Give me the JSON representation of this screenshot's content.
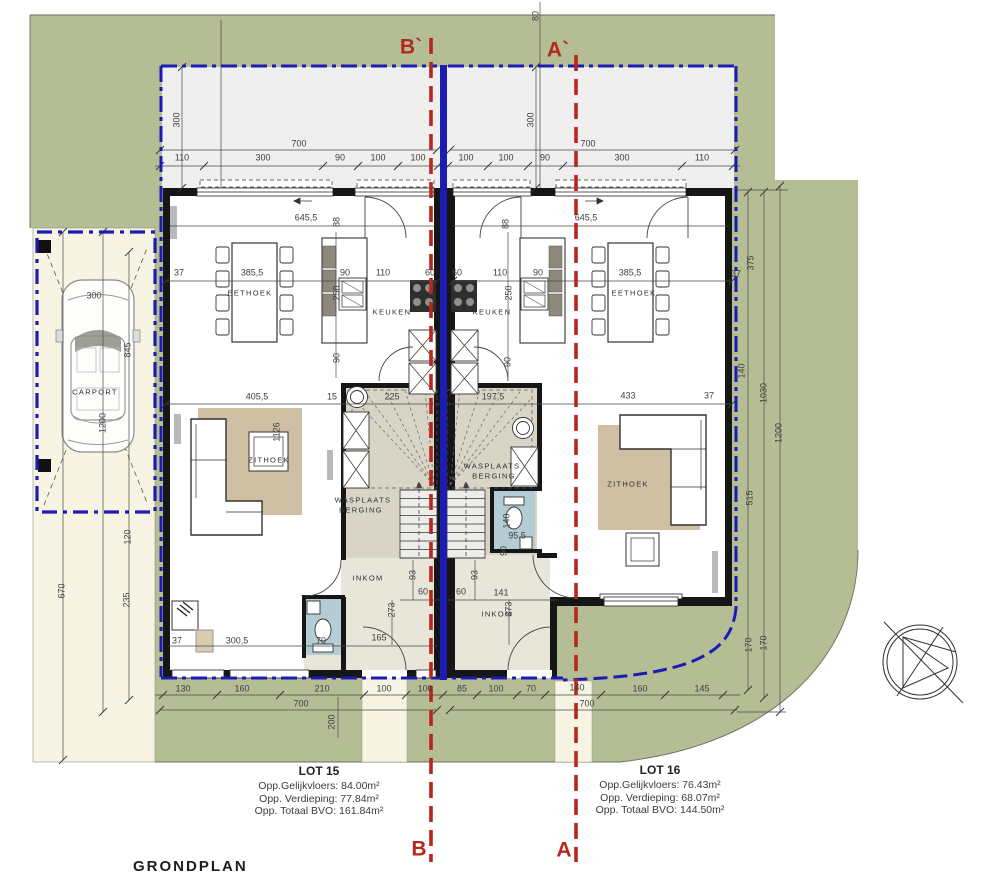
{
  "title": "GRONDPLAN",
  "section_labels": {
    "b_top": "B`",
    "a_top": "A`",
    "b_bottom": "B",
    "a_bottom": "A"
  },
  "lots": {
    "lot15": {
      "name": "LOT 15",
      "lines": [
        "Opp.Gelijkvloers: 84.00m²",
        "Opp. Verdieping: 77.84m²",
        "Opp. Totaal BVO: 161.84m²"
      ]
    },
    "lot16": {
      "name": "LOT 16",
      "lines": [
        "Opp.Gelijkvloers: 76.43m²",
        "Opp. Verdieping: 68.07m²",
        "Opp. Totaal BVO: 144.50m²"
      ]
    }
  },
  "rooms": [
    {
      "t": "EETHOEK",
      "x": 250,
      "y": 293
    },
    {
      "t": "EETHOEK",
      "x": 634,
      "y": 293
    },
    {
      "t": "KEUKEN",
      "x": 392,
      "y": 312
    },
    {
      "t": "KEUKEN",
      "x": 492,
      "y": 312
    },
    {
      "t": "ZITHOEK",
      "x": 269,
      "y": 460
    },
    {
      "t": "ZITHOEK",
      "x": 628,
      "y": 484
    },
    {
      "t": "WASPLAATS",
      "x": 363,
      "y": 500
    },
    {
      "t": "BERGING",
      "x": 361,
      "y": 510
    },
    {
      "t": "WASPLAATS",
      "x": 492,
      "y": 466
    },
    {
      "t": "BERGING",
      "x": 494,
      "y": 476
    },
    {
      "t": "INKOM",
      "x": 368,
      "y": 578
    },
    {
      "t": "INKOM",
      "x": 497,
      "y": 614
    },
    {
      "t": "CARPORT",
      "x": 95,
      "y": 392
    }
  ],
  "dimensions": [
    {
      "t": "700",
      "x": 299,
      "y": 144
    },
    {
      "t": "700",
      "x": 588,
      "y": 144
    },
    {
      "t": "110",
      "x": 182,
      "y": 158
    },
    {
      "t": "300",
      "x": 263,
      "y": 158
    },
    {
      "t": "90",
      "x": 340,
      "y": 158
    },
    {
      "t": "100",
      "x": 378,
      "y": 158
    },
    {
      "t": "100",
      "x": 418,
      "y": 158
    },
    {
      "t": "100",
      "x": 466,
      "y": 158
    },
    {
      "t": "100",
      "x": 506,
      "y": 158
    },
    {
      "t": "90",
      "x": 545,
      "y": 158
    },
    {
      "t": "300",
      "x": 622,
      "y": 158
    },
    {
      "t": "110",
      "x": 702,
      "y": 158
    },
    {
      "t": "300",
      "x": 177,
      "y": 120,
      "r": 1
    },
    {
      "t": "300",
      "x": 531,
      "y": 120,
      "r": 1
    },
    {
      "t": "80",
      "x": 536,
      "y": 16,
      "r": 1
    },
    {
      "t": "645,5",
      "x": 306,
      "y": 218
    },
    {
      "t": "645,5",
      "x": 586,
      "y": 218
    },
    {
      "t": "88",
      "x": 337,
      "y": 222,
      "r": 1
    },
    {
      "t": "88",
      "x": 506,
      "y": 224,
      "r": 1
    },
    {
      "t": "37",
      "x": 179,
      "y": 273
    },
    {
      "t": "385,5",
      "x": 252,
      "y": 273
    },
    {
      "t": "90",
      "x": 345,
      "y": 273
    },
    {
      "t": "110",
      "x": 383,
      "y": 273
    },
    {
      "t": "60",
      "x": 430,
      "y": 273
    },
    {
      "t": "60",
      "x": 457,
      "y": 273
    },
    {
      "t": "110",
      "x": 500,
      "y": 273
    },
    {
      "t": "90",
      "x": 538,
      "y": 273
    },
    {
      "t": "385,5",
      "x": 630,
      "y": 273
    },
    {
      "t": "37",
      "x": 736,
      "y": 274
    },
    {
      "t": "250",
      "x": 337,
      "y": 293,
      "r": 1
    },
    {
      "t": "250",
      "x": 509,
      "y": 293,
      "r": 1
    },
    {
      "t": "90",
      "x": 337,
      "y": 358,
      "r": 1
    },
    {
      "t": "90",
      "x": 508,
      "y": 362,
      "r": 1
    },
    {
      "t": "405,5",
      "x": 257,
      "y": 397
    },
    {
      "t": "15",
      "x": 332,
      "y": 397
    },
    {
      "t": "225",
      "x": 392,
      "y": 397
    },
    {
      "t": "197,5",
      "x": 493,
      "y": 397
    },
    {
      "t": "433",
      "x": 628,
      "y": 396
    },
    {
      "t": "37",
      "x": 709,
      "y": 396
    },
    {
      "t": "1126",
      "x": 277,
      "y": 432,
      "r": 1
    },
    {
      "t": "140",
      "x": 507,
      "y": 521,
      "r": 1
    },
    {
      "t": "95,5",
      "x": 517,
      "y": 536
    },
    {
      "t": "90",
      "x": 504,
      "y": 551,
      "r": 1
    },
    {
      "t": "93",
      "x": 413,
      "y": 575,
      "r": 1
    },
    {
      "t": "93",
      "x": 475,
      "y": 575,
      "r": 1
    },
    {
      "t": "273",
      "x": 392,
      "y": 610,
      "r": 1
    },
    {
      "t": "273",
      "x": 509,
      "y": 609,
      "r": 1
    },
    {
      "t": "60",
      "x": 423,
      "y": 592
    },
    {
      "t": "60",
      "x": 461,
      "y": 592
    },
    {
      "t": "141",
      "x": 501,
      "y": 593
    },
    {
      "t": "165",
      "x": 379,
      "y": 638
    },
    {
      "t": "70",
      "x": 321,
      "y": 641
    },
    {
      "t": "300,5",
      "x": 237,
      "y": 641
    },
    {
      "t": "37",
      "x": 177,
      "y": 641
    },
    {
      "t": "130",
      "x": 183,
      "y": 689
    },
    {
      "t": "160",
      "x": 242,
      "y": 689
    },
    {
      "t": "210",
      "x": 322,
      "y": 689
    },
    {
      "t": "100",
      "x": 384,
      "y": 689
    },
    {
      "t": "100",
      "x": 425,
      "y": 689
    },
    {
      "t": "85",
      "x": 462,
      "y": 689
    },
    {
      "t": "100",
      "x": 496,
      "y": 689
    },
    {
      "t": "70",
      "x": 531,
      "y": 689
    },
    {
      "t": "140",
      "x": 577,
      "y": 688
    },
    {
      "t": "160",
      "x": 640,
      "y": 689
    },
    {
      "t": "145",
      "x": 702,
      "y": 689
    },
    {
      "t": "700",
      "x": 301,
      "y": 704
    },
    {
      "t": "700",
      "x": 587,
      "y": 704
    },
    {
      "t": "200",
      "x": 332,
      "y": 722,
      "r": 1
    },
    {
      "t": "300",
      "x": 94,
      "y": 296
    },
    {
      "t": "845",
      "x": 128,
      "y": 350,
      "r": 1
    },
    {
      "t": "1200",
      "x": 103,
      "y": 423,
      "r": 1
    },
    {
      "t": "120",
      "x": 128,
      "y": 537,
      "r": 1
    },
    {
      "t": "235",
      "x": 127,
      "y": 600,
      "r": 1
    },
    {
      "t": "670",
      "x": 62,
      "y": 591,
      "r": 1
    },
    {
      "t": "375",
      "x": 751,
      "y": 263,
      "r": 1
    },
    {
      "t": "140",
      "x": 742,
      "y": 371,
      "r": 1
    },
    {
      "t": "1030",
      "x": 764,
      "y": 393,
      "r": 1
    },
    {
      "t": "1200",
      "x": 779,
      "y": 433,
      "r": 1
    },
    {
      "t": "515",
      "x": 750,
      "y": 498,
      "r": 1
    },
    {
      "t": "170",
      "x": 749,
      "y": 645,
      "r": 1
    },
    {
      "t": "170",
      "x": 764,
      "y": 643,
      "r": 1
    }
  ],
  "colors": {
    "site_green": "#b5bd94",
    "driveway_cream": "#f8f4e4",
    "garden_gray": "#efefef",
    "core_greige": "#d8d5c6",
    "inkom_greige": "#e8e5d9",
    "rug_tan": "#cfc0a3",
    "wc_blue": "#b4ccd4",
    "boundary_blue": "#1c1cb4",
    "section_red": "#b4281e",
    "wall_black": "#161616"
  }
}
